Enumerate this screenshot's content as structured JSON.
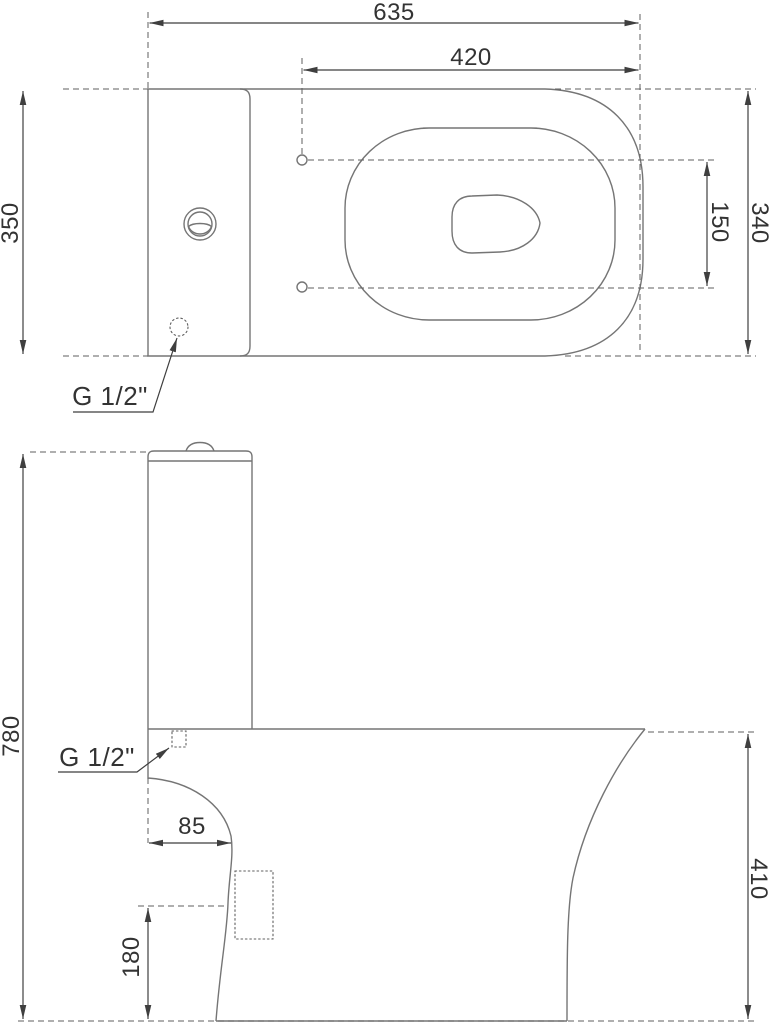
{
  "drawing": {
    "kind": "technical-dimension-drawing",
    "views": [
      "plan (top) view",
      "side elevation"
    ],
    "colors": {
      "background": "#ffffff",
      "outline": "#757575",
      "dimension_lines": "#3f3f3f",
      "text": "#333333"
    }
  },
  "labels": {
    "dim_635": "635",
    "dim_420": "420",
    "dim_350": "350",
    "dim_340": "340",
    "dim_150": "150",
    "dim_780": "780",
    "dim_85": "85",
    "dim_180": "180",
    "dim_410": "410",
    "inlet_plan": "G 1/2\"",
    "inlet_side": "G 1/2\""
  },
  "dimensions_mm": {
    "overall_length": 635,
    "bowl_front_to_hinge": 420,
    "cistern_width": 350,
    "bowl_width": 340,
    "hinge_hole_spacing": 150,
    "overall_height": 780,
    "front_overhang": 85,
    "outlet_center_height": 180,
    "bowl_rim_height": 410,
    "water_inlet_thread": "G 1/2\""
  }
}
